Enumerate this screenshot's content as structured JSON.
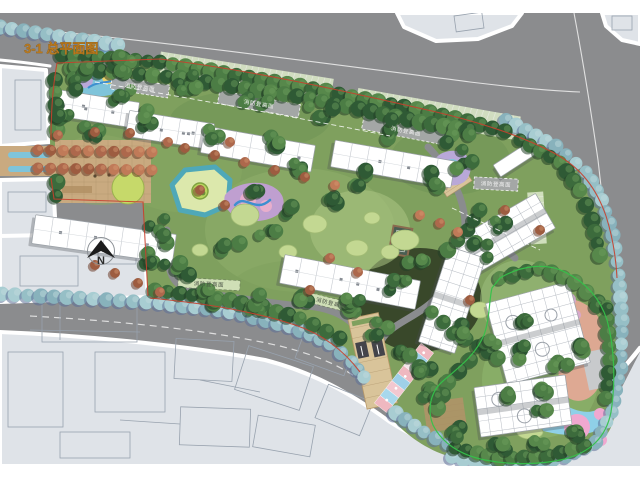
{
  "title": {
    "text": "3-1 总平面图"
  },
  "drawing": {
    "type": "residential-landscape-master-plan",
    "north_label": "N",
    "fire_lane_label": "消防登高面",
    "fire_lane_count": 6
  },
  "palette": {
    "road": "#8b8c8e",
    "context": "#dfe3e8",
    "context_line": "#98a2ae",
    "sidewalk": "#ffffff",
    "site_green": "#7fa05e",
    "green_dark": "#3f6d3f",
    "lawn": "#c3d892",
    "lawn_bright": "#cfe2a0",
    "tree_dark": "#2f5a35",
    "tree_teal": "#96bfc6",
    "teal_shadow": "#5d6f97",
    "tree_red": "#ad684c",
    "path_tan": "#c9aa80",
    "deck": "#d9c49a",
    "deck_line": "#a98f66",
    "water": "#7fc4da",
    "pond_rim": "#4fa8b8",
    "pond_fill": "#dce8ac",
    "island": "#b8d45e",
    "play_purple": "#bf9fd0",
    "play_pink": "#e8aecc",
    "play_blue": "#3e8fd0",
    "pool_yellow": "#ead06c",
    "lavender": "#b9a8d8",
    "salmon": "#e8a898",
    "boundary_red": "#c8402e",
    "boundary_green": "#35c24a",
    "building": "#ffffff",
    "building_line": "#9aa0a6",
    "shadow": "#4a4d55",
    "bar": "#a6a8aa",
    "bar_light": "#d4e3bb",
    "label_light": "#f2f2f2",
    "label_dark": "#4a5246",
    "title": "#b8791f",
    "hatch_green": "#d9e6c6",
    "court": "#4a5e52"
  }
}
